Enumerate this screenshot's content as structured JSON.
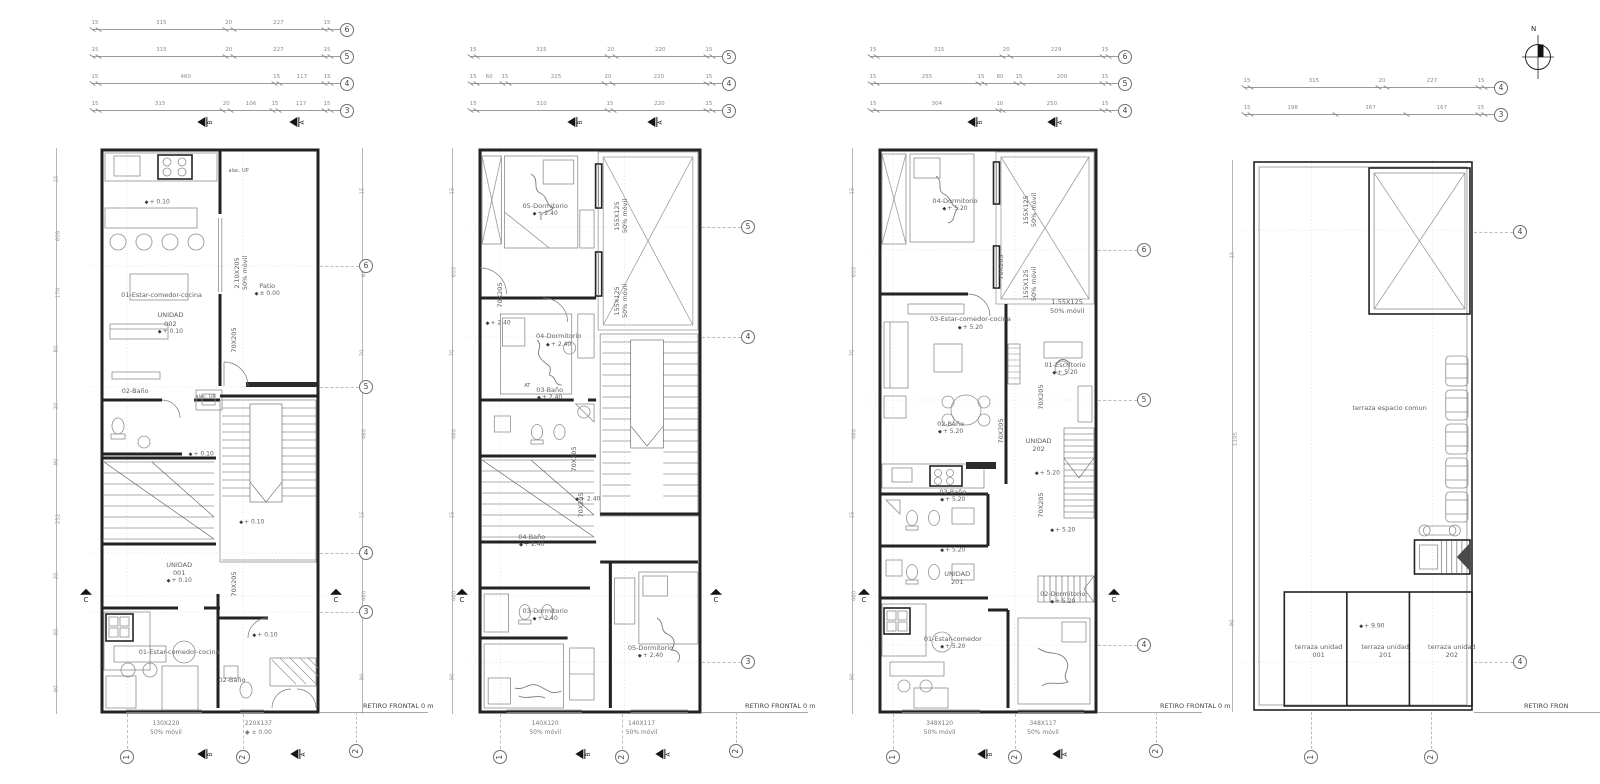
{
  "sheet": {
    "background": "#ffffff",
    "line_color": "#232323",
    "annotation_color": "#8a8a8a",
    "north_arrow": {
      "label": "N"
    },
    "plans": [
      {
        "rect": {
          "x": 100,
          "y": 148,
          "w": 220,
          "h": 566
        },
        "dim_rows": [
          {
            "bubble": "6",
            "segments": [
              "15",
              "315",
              "20",
              "227",
              "15"
            ]
          },
          {
            "bubble": "5",
            "segments": [
              "15",
              "315",
              "20",
              "227",
              "15"
            ]
          },
          {
            "bubble": "4",
            "segments": [
              "15",
              "460",
              "15",
              "117",
              "15"
            ]
          },
          {
            "bubble": "3",
            "segments": [
              "15",
              "315",
              "20",
              "106",
              "15",
              "117",
              "15"
            ]
          }
        ],
        "top_marks": [
          {
            "label": "B",
            "x": 205
          },
          {
            "label": "A",
            "x": 297
          }
        ],
        "bottom_marks": [
          {
            "label": "B",
            "x": 205
          },
          {
            "label": "A",
            "x": 298
          }
        ],
        "grid_bubbles": [
          {
            "l": "6",
            "y": 266
          },
          {
            "l": "5",
            "y": 387
          },
          {
            "l": "4",
            "y": 553
          },
          {
            "l": "3",
            "y": 612
          }
        ],
        "c_markers": {
          "label": "C",
          "y": 596,
          "left": 86,
          "right": 336
        },
        "bottom_bubbles": [
          {
            "l": "1",
            "x": 127
          },
          {
            "l": "2",
            "x": 243
          }
        ],
        "strips": [
          {
            "x": 56,
            "values": [
              "15",
              "608",
              "170",
              "80",
              "20",
              "90",
              "252",
              "35",
              "85",
              "90"
            ]
          },
          {
            "x": 362,
            "values": [
              "15",
              "605",
              "70",
              "460",
              "15",
              "460",
              "90"
            ]
          }
        ],
        "labels": [
          {
            "lvl": "+ 0.10",
            "x": 26,
            "y": 9.5
          },
          {
            "t": "01-Estar-comedor-cocina",
            "x": 28,
            "y": 26
          },
          {
            "t": "UNIDAD",
            "t2": "002",
            "lvl": "+ 0.10",
            "x": 32,
            "y": 31
          },
          {
            "t": "Patio",
            "lvl": "± 0.00",
            "x": 76,
            "y": 25
          },
          {
            "t": "alac. UP",
            "x": 63,
            "y": 4,
            "size": 5
          },
          {
            "t": "2.10X205",
            "t2": "50% móvil",
            "x": 64,
            "y": 22,
            "rot": 1
          },
          {
            "t": "70X205",
            "x": 61,
            "y": 34,
            "rot": 1
          },
          {
            "t": "02-Baño",
            "x": 16,
            "y": 43
          },
          {
            "t": "alac. UP",
            "x": 48,
            "y": 44,
            "size": 5
          },
          {
            "lvl": "+ 0.10",
            "x": 46,
            "y": 54
          },
          {
            "lvl": "+ 0.10",
            "x": 69,
            "y": 66
          },
          {
            "t": "UNIDAD",
            "t2": "001",
            "lvl": "+ 0.10",
            "x": 36,
            "y": 75
          },
          {
            "t": "70X205",
            "x": 61,
            "y": 77,
            "rot": 1
          },
          {
            "t": "01-Estar-comedor-cocina",
            "x": 36,
            "y": 89
          },
          {
            "lvl": "+ 0.10",
            "x": 75,
            "y": 86
          },
          {
            "t": "02-Baño",
            "x": 60,
            "y": 94
          }
        ],
        "bottom_labels": [
          {
            "x": 30,
            "l1": "130X220",
            "l2": "50% móvil"
          },
          {
            "x": 72,
            "l1": "220X137",
            "l2": "◆ ± 0.00"
          }
        ],
        "retiro": {
          "text": "RETIRO FRONTAL 0 m",
          "x": 363,
          "y": 702,
          "lot_w": 108,
          "bubble": {
            "l": "2",
            "x": 356,
            "y": 751
          }
        }
      },
      {
        "rect": {
          "x": 478,
          "y": 148,
          "w": 224,
          "h": 566
        },
        "dim_rows": [
          {
            "bubble": "5",
            "segments": [
              "15",
              "315",
              "20",
              "220",
              "15"
            ]
          },
          {
            "bubble": "4",
            "segments": [
              "15",
              "60",
              "15",
              "225",
              "20",
              "220",
              "15"
            ]
          },
          {
            "bubble": "3",
            "segments": [
              "15",
              "310",
              "15",
              "220",
              "15"
            ]
          }
        ],
        "top_marks": [
          {
            "label": "B",
            "x": 575
          },
          {
            "label": "A",
            "x": 655
          }
        ],
        "bottom_marks": [
          {
            "label": "B",
            "x": 583
          },
          {
            "label": "A",
            "x": 663
          }
        ],
        "grid_bubbles": [
          {
            "l": "5",
            "y": 227
          },
          {
            "l": "4",
            "y": 337
          },
          {
            "l": "3",
            "y": 662
          }
        ],
        "c_markers": {
          "label": "C",
          "y": 596,
          "left": 462,
          "right": 716
        },
        "bottom_bubbles": [
          {
            "l": "1",
            "x": 500
          },
          {
            "l": "2",
            "x": 622
          }
        ],
        "strips": [
          {
            "x": 452,
            "values": [
              "15",
              "605",
              "70",
              "460",
              "15",
              "460",
              "90"
            ]
          }
        ],
        "labels": [
          {
            "t": "05-Dormitorio",
            "lvl": "+ 2.40",
            "x": 30,
            "y": 11
          },
          {
            "t": "155X125",
            "t2": "50% móvil",
            "x": 64,
            "y": 12,
            "rot": 1
          },
          {
            "t": "70X205",
            "x": 10,
            "y": 26,
            "rot": 1
          },
          {
            "t": "155X125",
            "t2": "50% móvil",
            "x": 64,
            "y": 27,
            "rot": 1
          },
          {
            "lvl": "+ 2.40",
            "x": 9,
            "y": 31
          },
          {
            "t": "04-Dormitorio",
            "lvl": "+ 2.40",
            "x": 36,
            "y": 34
          },
          {
            "t": "AT",
            "x": 22,
            "y": 42,
            "size": 5
          },
          {
            "t": "03-Baño",
            "lvl": "+ 2.40",
            "x": 32,
            "y": 43.5
          },
          {
            "t": "70X205",
            "x": 43,
            "y": 55,
            "rot": 1
          },
          {
            "lvl": "+ 2.40",
            "x": 49,
            "y": 62
          },
          {
            "t": "70X205",
            "x": 46,
            "y": 63,
            "rot": 1
          },
          {
            "t": "04-Baño",
            "lvl": "+ 2.40",
            "x": 24,
            "y": 69.5
          },
          {
            "t": "03-Dormitorio",
            "lvl": "+ 2.40",
            "x": 30,
            "y": 82.5
          },
          {
            "t": "05-Dormitorio",
            "lvl": "+ 2.40",
            "x": 77,
            "y": 89
          }
        ],
        "bottom_labels": [
          {
            "x": 30,
            "l1": "140X120",
            "l2": "50% móvil"
          },
          {
            "x": 73,
            "l1": "140X117",
            "l2": "50% móvil"
          }
        ],
        "retiro": {
          "text": "RETIRO FRONTAL 0 m",
          "x": 745,
          "y": 702,
          "lot_w": 106,
          "bubble": {
            "l": "2",
            "x": 736,
            "y": 751
          }
        }
      },
      {
        "rect": {
          "x": 878,
          "y": 148,
          "w": 220,
          "h": 566
        },
        "dim_rows": [
          {
            "bubble": "6",
            "segments": [
              "15",
              "315",
              "20",
              "229",
              "15"
            ]
          },
          {
            "bubble": "5",
            "segments": [
              "15",
              "255",
              "15",
              "80",
              "15",
              "200",
              "15"
            ]
          },
          {
            "bubble": "4",
            "segments": [
              "15",
              "304",
              "10",
              "250",
              "15"
            ]
          }
        ],
        "top_marks": [
          {
            "label": "B",
            "x": 975
          },
          {
            "label": "A",
            "x": 1055
          }
        ],
        "bottom_marks": [
          {
            "label": "B",
            "x": 985
          },
          {
            "label": "A",
            "x": 1060
          }
        ],
        "grid_bubbles": [
          {
            "l": "6",
            "y": 250
          },
          {
            "l": "5",
            "y": 400
          },
          {
            "l": "4",
            "y": 645
          }
        ],
        "c_markers": {
          "label": "C",
          "y": 596,
          "left": 864,
          "right": 1114
        },
        "bottom_bubbles": [
          {
            "l": "1",
            "x": 893
          },
          {
            "l": "2",
            "x": 1015
          }
        ],
        "strips": [
          {
            "x": 852,
            "values": [
              "15",
              "605",
              "70",
              "460",
              "15",
              "460",
              "90"
            ]
          }
        ],
        "labels": [
          {
            "t": "04-Dormitorio",
            "lvl": "+ 5.20",
            "x": 35,
            "y": 10
          },
          {
            "t": "155X125",
            "t2": "50% móvil",
            "x": 69,
            "y": 11,
            "rot": 1
          },
          {
            "t": "70X205",
            "x": 56,
            "y": 21,
            "rot": 1
          },
          {
            "t": "155X125",
            "t2": "50% móvil",
            "x": 69,
            "y": 24,
            "rot": 1
          },
          {
            "t": "1.55X125",
            "t2": "50% móvil",
            "x": 86,
            "y": 28
          },
          {
            "t": "03-Estar-comedor-cocina",
            "lvl": "+ 5.20",
            "x": 42,
            "y": 31
          },
          {
            "t": "01-Escritorio",
            "lvl": "+ 5.20",
            "x": 85,
            "y": 39
          },
          {
            "t": "70X205",
            "x": 74,
            "y": 44,
            "rot": 1
          },
          {
            "t": "02-Baño",
            "lvl": "+ 5.20",
            "x": 33,
            "y": 49.5
          },
          {
            "t": "70X205",
            "x": 56,
            "y": 50,
            "rot": 1
          },
          {
            "t": "UNIDAD",
            "t2": "202",
            "x": 73,
            "y": 52.5
          },
          {
            "lvl": "+ 5.20",
            "x": 77,
            "y": 57.5
          },
          {
            "t": "03-Baño",
            "lvl": "+ 5.20",
            "x": 34,
            "y": 61.5
          },
          {
            "t": "70X205",
            "x": 74,
            "y": 63,
            "rot": 1
          },
          {
            "lvl": "+ 5.20",
            "x": 84,
            "y": 67.5
          },
          {
            "lvl": "+ 5.20",
            "x": 34,
            "y": 71
          },
          {
            "t": "UNIDAD",
            "t2": "201",
            "x": 36,
            "y": 76
          },
          {
            "t": "02-Dormitorio",
            "lvl": "+ 5.20",
            "x": 84,
            "y": 79.5
          },
          {
            "t": "01-Estar-comedor",
            "lvl": "+ 5.20",
            "x": 34,
            "y": 87.5
          }
        ],
        "bottom_labels": [
          {
            "x": 28,
            "l1": "348X120",
            "l2": "50% móvil"
          },
          {
            "x": 75,
            "l1": "348X117",
            "l2": "50% móvil"
          }
        ],
        "retiro": {
          "text": "RETIRO FRONTAL 0 m",
          "x": 1160,
          "y": 702,
          "lot_w": 104,
          "bubble": {
            "l": "2",
            "x": 1156,
            "y": 751
          }
        }
      },
      {
        "rect": {
          "x": 1252,
          "y": 160,
          "w": 222,
          "h": 552
        },
        "dim_rows": [
          {
            "bubble": "4",
            "segments": [
              "15",
              "315",
              "20",
              "227",
              "15"
            ]
          },
          {
            "bubble": "3",
            "segments": [
              "15",
              "198",
              "167",
              "167",
              "15"
            ]
          }
        ],
        "top_marks": [],
        "bottom_marks": [],
        "grid_bubbles": [
          {
            "l": "4",
            "y": 232
          },
          {
            "l": "4",
            "y": 662
          }
        ],
        "bottom_bubbles": [
          {
            "l": "1",
            "x": 1311
          },
          {
            "l": "2",
            "x": 1431
          }
        ],
        "strips": [
          {
            "x": 1232,
            "values": [
              "15",
              "1195",
              "90"
            ]
          }
        ],
        "labels": [
          {
            "t": "terraza espacio comun",
            "x": 62,
            "y": 45
          },
          {
            "lvl": "+ 9.90",
            "x": 54,
            "y": 84.5
          },
          {
            "t": "terraza unidad",
            "t2": "001",
            "x": 30,
            "y": 89
          },
          {
            "t": "terraza unidad",
            "t2": "201",
            "x": 60,
            "y": 89
          },
          {
            "t": "terraza unidad",
            "t2": "202",
            "x": 90,
            "y": 89
          }
        ],
        "bottom_labels": [],
        "retiro": {
          "text": "RETIRO FRON",
          "x": 1524,
          "y": 702,
          "lot_w": 126
        }
      }
    ]
  }
}
